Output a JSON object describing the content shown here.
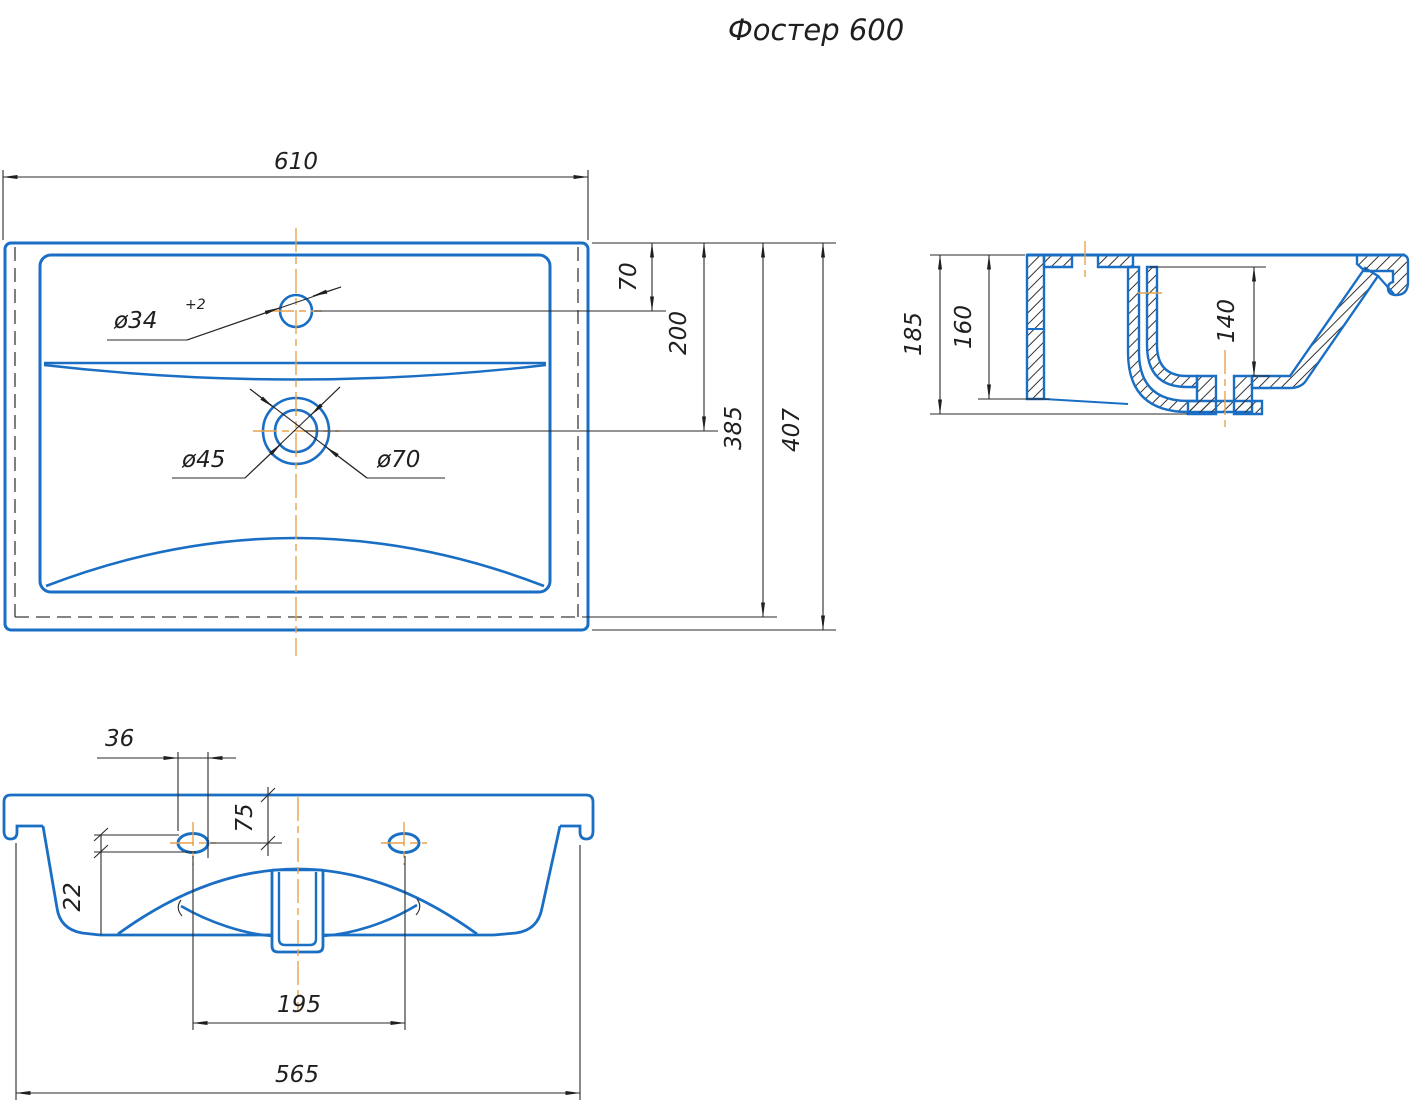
{
  "title": "Фостер 600",
  "colors": {
    "part_line": "#1a6fc4",
    "dim_line": "#2a2a2a",
    "centerline": "#e8a24b",
    "background": "#ffffff"
  },
  "top_view": {
    "dims": {
      "d610": "610",
      "d70": "70",
      "d200": "200",
      "d385": "385",
      "d407": "407"
    },
    "holes": {
      "faucet": "ø34",
      "faucet_tol": "+2",
      "drain_inner": "ø45",
      "drain_outer": "ø70"
    }
  },
  "section_view": {
    "dims": {
      "d185": "185",
      "d160": "160",
      "d140": "140"
    }
  },
  "bottom_view": {
    "dims": {
      "d36": "36",
      "d75": "75",
      "d22": "22",
      "d195": "195",
      "d565": "565"
    }
  }
}
